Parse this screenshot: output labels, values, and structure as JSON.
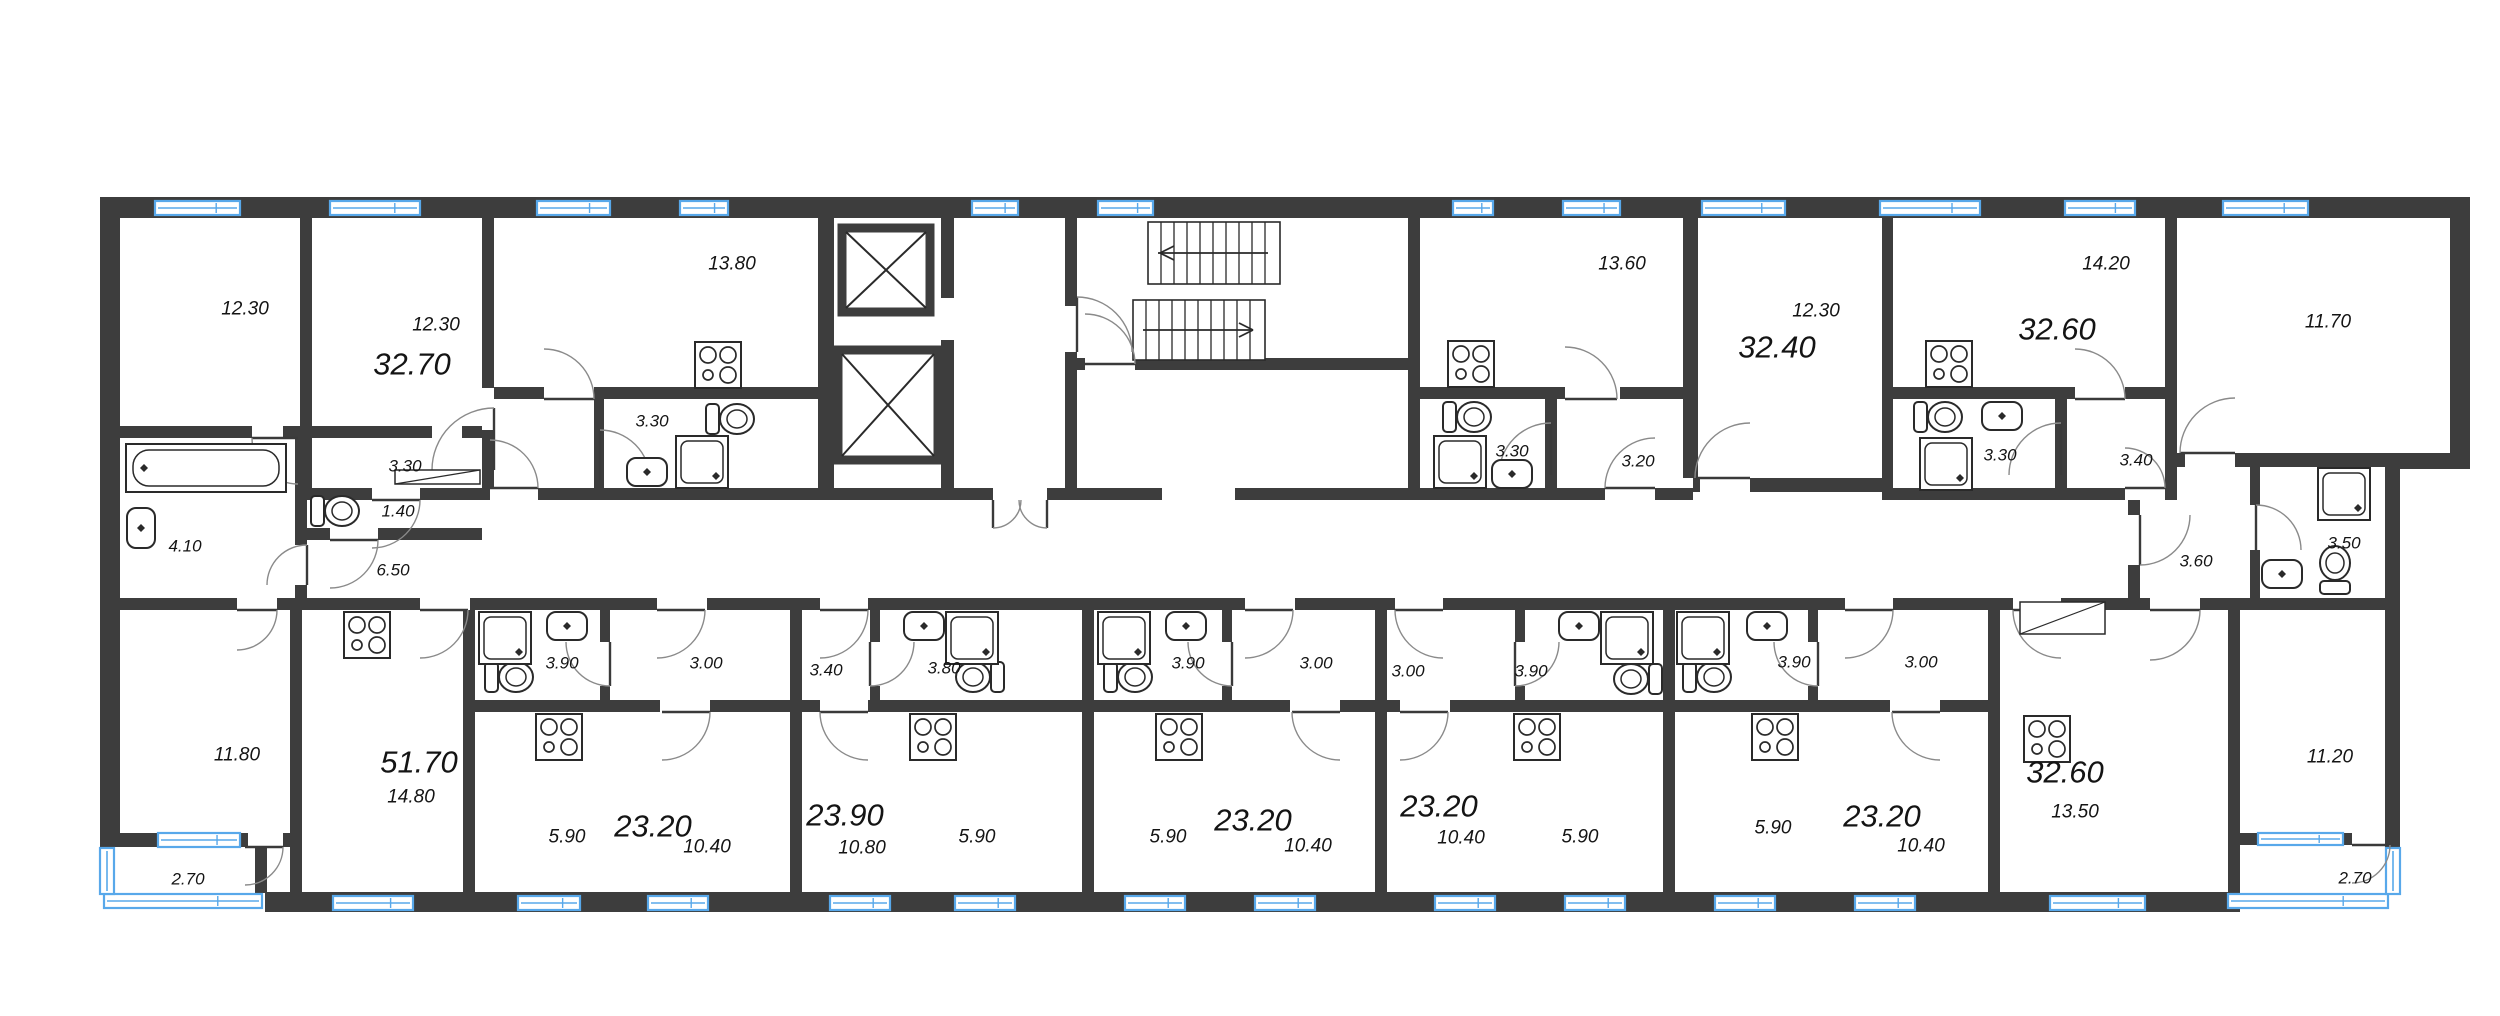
{
  "plan": {
    "type": "residential-floor-plan",
    "colors": {
      "wall": "#3d3d3d",
      "window_stroke": "#58a8ea",
      "window_fill": "#ffffff",
      "fixture_line": "#2a2a2a",
      "door_arc": "#8a8a8a",
      "text": "#141414"
    },
    "icons": [
      "stove-icon",
      "toilet-icon",
      "sink-icon",
      "shower-icon",
      "bathtub-icon",
      "elevator-shaft-icon",
      "stairs-icon",
      "window-icon",
      "door-arc-icon",
      "wardrobe-icon"
    ]
  },
  "labels": [
    {
      "kind": "room-area",
      "text": "12.30",
      "x": 245,
      "y": 309,
      "cls": "small"
    },
    {
      "kind": "room-area",
      "text": "12.30",
      "x": 436,
      "y": 325,
      "cls": "small"
    },
    {
      "kind": "apartment-total",
      "text": "32.70",
      "x": 412,
      "y": 364,
      "cls": "big"
    },
    {
      "kind": "room-area",
      "text": "13.80",
      "x": 732,
      "y": 264,
      "cls": "small"
    },
    {
      "kind": "room-area",
      "text": "3.30",
      "x": 652,
      "y": 421,
      "cls": "tiny"
    },
    {
      "kind": "room-area",
      "text": "3.30",
      "x": 405,
      "y": 466,
      "cls": "tiny"
    },
    {
      "kind": "room-area",
      "text": "1.40",
      "x": 398,
      "y": 511,
      "cls": "tiny"
    },
    {
      "kind": "room-area",
      "text": "4.10",
      "x": 185,
      "y": 546,
      "cls": "tiny"
    },
    {
      "kind": "room-area",
      "text": "6.50",
      "x": 393,
      "y": 570,
      "cls": "tiny"
    },
    {
      "kind": "room-area",
      "text": "13.60",
      "x": 1622,
      "y": 264,
      "cls": "small"
    },
    {
      "kind": "room-area",
      "text": "3.30",
      "x": 1512,
      "y": 451,
      "cls": "tiny"
    },
    {
      "kind": "room-area",
      "text": "3.20",
      "x": 1638,
      "y": 461,
      "cls": "tiny"
    },
    {
      "kind": "room-area",
      "text": "12.30",
      "x": 1816,
      "y": 311,
      "cls": "small"
    },
    {
      "kind": "apartment-total",
      "text": "32.40",
      "x": 1777,
      "y": 347,
      "cls": "big"
    },
    {
      "kind": "room-area",
      "text": "14.20",
      "x": 2106,
      "y": 264,
      "cls": "small"
    },
    {
      "kind": "apartment-total",
      "text": "32.60",
      "x": 2057,
      "y": 329,
      "cls": "big"
    },
    {
      "kind": "room-area",
      "text": "3.30",
      "x": 2000,
      "y": 455,
      "cls": "tiny"
    },
    {
      "kind": "room-area",
      "text": "3.40",
      "x": 2136,
      "y": 460,
      "cls": "tiny"
    },
    {
      "kind": "room-area",
      "text": "11.70",
      "x": 2328,
      "y": 322,
      "cls": "small"
    },
    {
      "kind": "room-area",
      "text": "3.60",
      "x": 2196,
      "y": 561,
      "cls": "tiny"
    },
    {
      "kind": "room-area",
      "text": "3.50",
      "x": 2344,
      "y": 543,
      "cls": "tiny"
    },
    {
      "kind": "room-area",
      "text": "11.80",
      "x": 237,
      "y": 755,
      "cls": "small"
    },
    {
      "kind": "room-area",
      "text": "2.70",
      "x": 188,
      "y": 879,
      "cls": "tiny"
    },
    {
      "kind": "apartment-total",
      "text": "51.70",
      "x": 419,
      "y": 762,
      "cls": "big"
    },
    {
      "kind": "room-area",
      "text": "14.80",
      "x": 411,
      "y": 797,
      "cls": "small"
    },
    {
      "kind": "room-area",
      "text": "3.90",
      "x": 562,
      "y": 663,
      "cls": "tiny"
    },
    {
      "kind": "room-area",
      "text": "3.00",
      "x": 706,
      "y": 663,
      "cls": "tiny"
    },
    {
      "kind": "room-area",
      "text": "5.90",
      "x": 567,
      "y": 837,
      "cls": "small"
    },
    {
      "kind": "apartment-total",
      "text": "23.20",
      "x": 653,
      "y": 826,
      "cls": "big"
    },
    {
      "kind": "room-area",
      "text": "10.40",
      "x": 707,
      "y": 847,
      "cls": "small"
    },
    {
      "kind": "room-area",
      "text": "3.40",
      "x": 826,
      "y": 670,
      "cls": "tiny"
    },
    {
      "kind": "room-area",
      "text": "3.80",
      "x": 944,
      "y": 668,
      "cls": "tiny"
    },
    {
      "kind": "apartment-total",
      "text": "23.90",
      "x": 845,
      "y": 815,
      "cls": "big"
    },
    {
      "kind": "room-area",
      "text": "10.80",
      "x": 862,
      "y": 848,
      "cls": "small"
    },
    {
      "kind": "room-area",
      "text": "5.90",
      "x": 977,
      "y": 837,
      "cls": "small"
    },
    {
      "kind": "room-area",
      "text": "3.90",
      "x": 1188,
      "y": 663,
      "cls": "tiny"
    },
    {
      "kind": "room-area",
      "text": "3.00",
      "x": 1316,
      "y": 663,
      "cls": "tiny"
    },
    {
      "kind": "room-area",
      "text": "5.90",
      "x": 1168,
      "y": 837,
      "cls": "small"
    },
    {
      "kind": "apartment-total",
      "text": "23.20",
      "x": 1253,
      "y": 820,
      "cls": "big"
    },
    {
      "kind": "room-area",
      "text": "10.40",
      "x": 1308,
      "y": 846,
      "cls": "small"
    },
    {
      "kind": "room-area",
      "text": "3.00",
      "x": 1408,
      "y": 671,
      "cls": "tiny"
    },
    {
      "kind": "room-area",
      "text": "3.90",
      "x": 1531,
      "y": 671,
      "cls": "tiny"
    },
    {
      "kind": "apartment-total",
      "text": "23.20",
      "x": 1439,
      "y": 806,
      "cls": "big"
    },
    {
      "kind": "room-area",
      "text": "10.40",
      "x": 1461,
      "y": 838,
      "cls": "small"
    },
    {
      "kind": "room-area",
      "text": "5.90",
      "x": 1580,
      "y": 837,
      "cls": "small"
    },
    {
      "kind": "room-area",
      "text": "3.90",
      "x": 1794,
      "y": 662,
      "cls": "tiny"
    },
    {
      "kind": "room-area",
      "text": "3.00",
      "x": 1921,
      "y": 662,
      "cls": "tiny"
    },
    {
      "kind": "room-area",
      "text": "5.90",
      "x": 1773,
      "y": 828,
      "cls": "small"
    },
    {
      "kind": "apartment-total",
      "text": "23.20",
      "x": 1882,
      "y": 816,
      "cls": "big"
    },
    {
      "kind": "room-area",
      "text": "10.40",
      "x": 1921,
      "y": 846,
      "cls": "small"
    },
    {
      "kind": "apartment-total",
      "text": "32.60",
      "x": 2065,
      "y": 772,
      "cls": "big"
    },
    {
      "kind": "room-area",
      "text": "13.50",
      "x": 2075,
      "y": 812,
      "cls": "small"
    },
    {
      "kind": "room-area",
      "text": "11.20",
      "x": 2330,
      "y": 757,
      "cls": "small"
    },
    {
      "kind": "room-area",
      "text": "2.70",
      "x": 2355,
      "y": 878,
      "cls": "tiny"
    }
  ]
}
